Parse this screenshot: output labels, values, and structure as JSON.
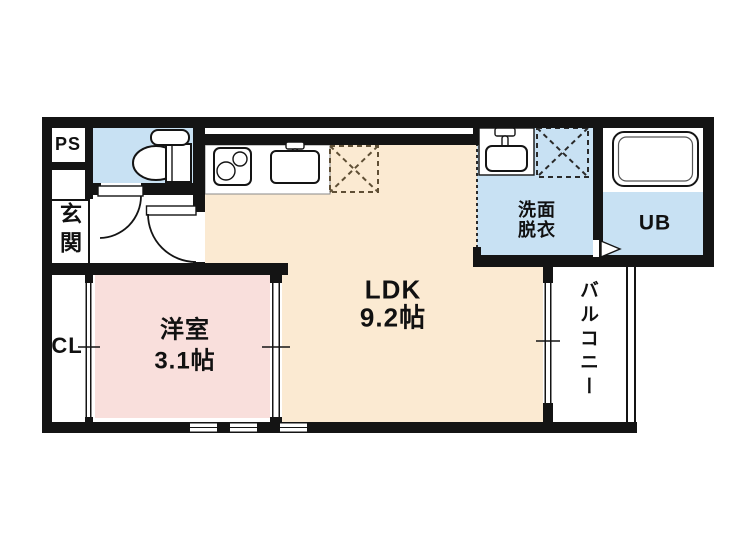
{
  "title": "apartment-floor-plan",
  "colors": {
    "wall": "#141414",
    "water_blue": "#C8E1F3",
    "ldk_cream": "#FBEAD2",
    "room_pink": "#F9DFDC",
    "fridge_dash": "#5f4f35"
  },
  "rooms": {
    "pipe_space": {
      "label": "PS"
    },
    "entrance": {
      "label": "玄関"
    },
    "closet": {
      "label": "CL"
    },
    "western_room": {
      "label": "洋室",
      "size": "3.1帖"
    },
    "ldk": {
      "label": "LDK",
      "size": "9.2帖"
    },
    "washroom": {
      "label_line1": "洗面",
      "label_line2": "脱衣"
    },
    "unit_bath": {
      "label": "UB"
    },
    "balcony": {
      "label": "バルコニー"
    }
  },
  "icons": {
    "toilet": "toilet-icon",
    "stove": "stove-icon",
    "kitchen_sink": "kitchen-sink-icon",
    "refrigerator_space": "refrigerator-space-icon",
    "washing_machine_space": "washing-machine-space-icon",
    "wash_basin": "wash-basin-icon",
    "bathtub": "bathtub-icon",
    "door_swings": "door-swing-icon",
    "bath_door": "bath-door-arrow-icon",
    "sliding_windows": "sliding-window-icon"
  }
}
